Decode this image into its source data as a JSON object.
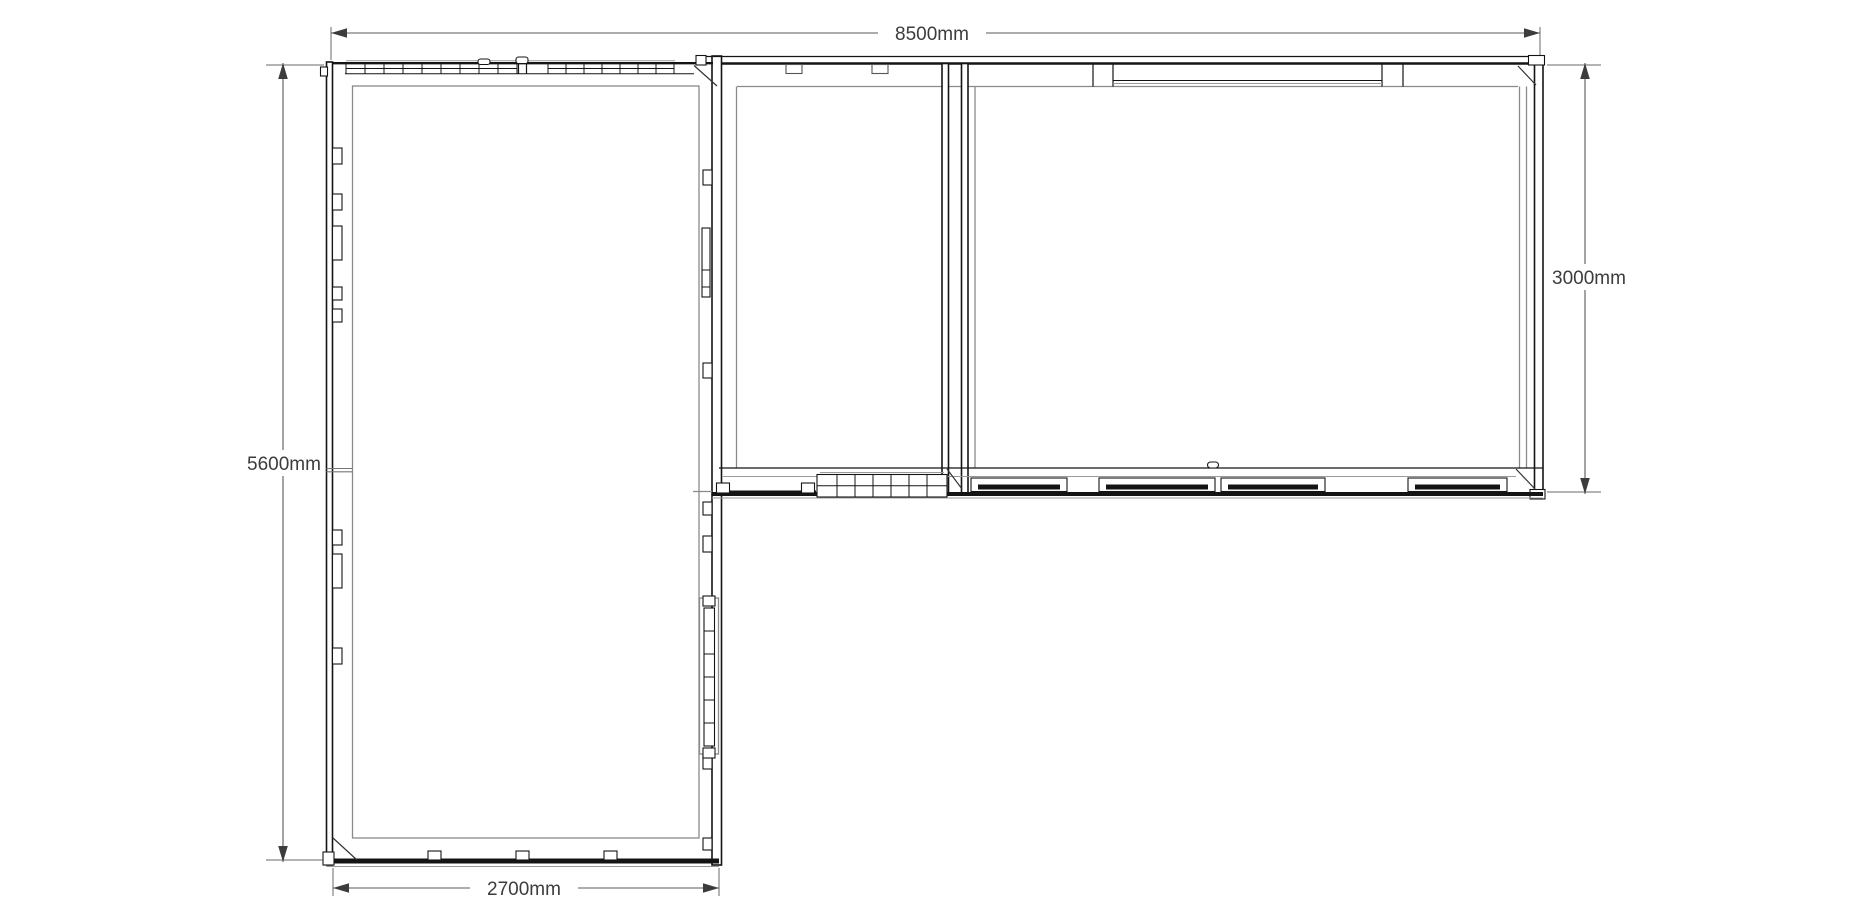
{
  "document": {
    "type": "architectural floor plan",
    "view": "top-down",
    "unit": "mm"
  },
  "dimensions": {
    "top": {
      "label": "8500mm",
      "value": 8500
    },
    "right": {
      "label": "3000mm",
      "value": 3000
    },
    "left": {
      "label": "5600mm",
      "value": 5600
    },
    "bottom": {
      "label": "2700mm",
      "value": 2700
    }
  },
  "colors": {
    "background": "#ffffff",
    "wall_line": "#141414",
    "inner_face_line": "#8a8a8a",
    "dimension_line": "#5a5a5a",
    "dimension_text": "#3c3c3c"
  }
}
